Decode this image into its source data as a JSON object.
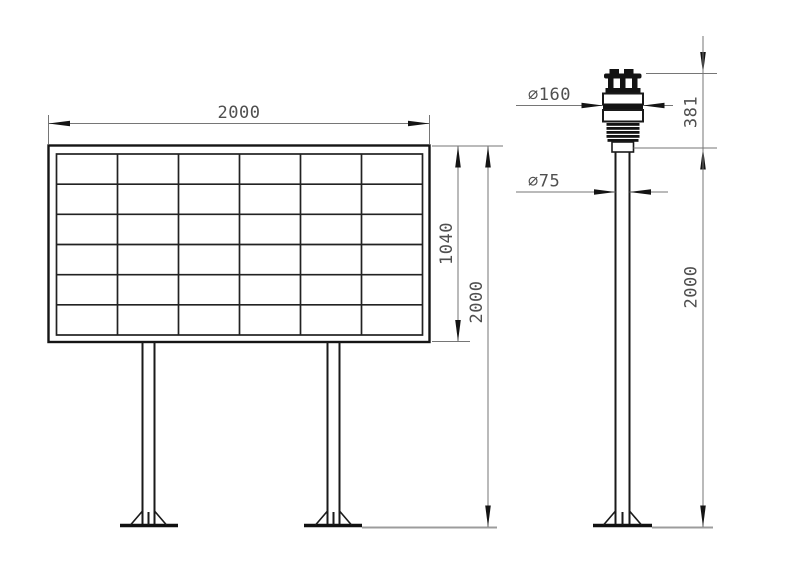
{
  "drawing": {
    "title": "display-board-and-sensor-pole-dimension-drawing",
    "background": "#ffffff",
    "colors": {
      "object_line": "#1a1a1a",
      "dimension_line": "#767676",
      "arrow": "#141414",
      "ground_line": "#9c9c9c",
      "text": "#4f4f4f"
    },
    "left_view": {
      "name": "display-board-front-view",
      "panel_grid": {
        "columns": 6,
        "rows": 6
      },
      "dims": {
        "board_width": "2000",
        "panel_height": "1040",
        "overall_height": "2000"
      }
    },
    "right_view": {
      "name": "sensor-pole-side-view",
      "dims": {
        "sensor_diameter": "∅160",
        "pole_diameter": "∅75",
        "sensor_height": "381",
        "pole_height": "2000"
      }
    }
  }
}
